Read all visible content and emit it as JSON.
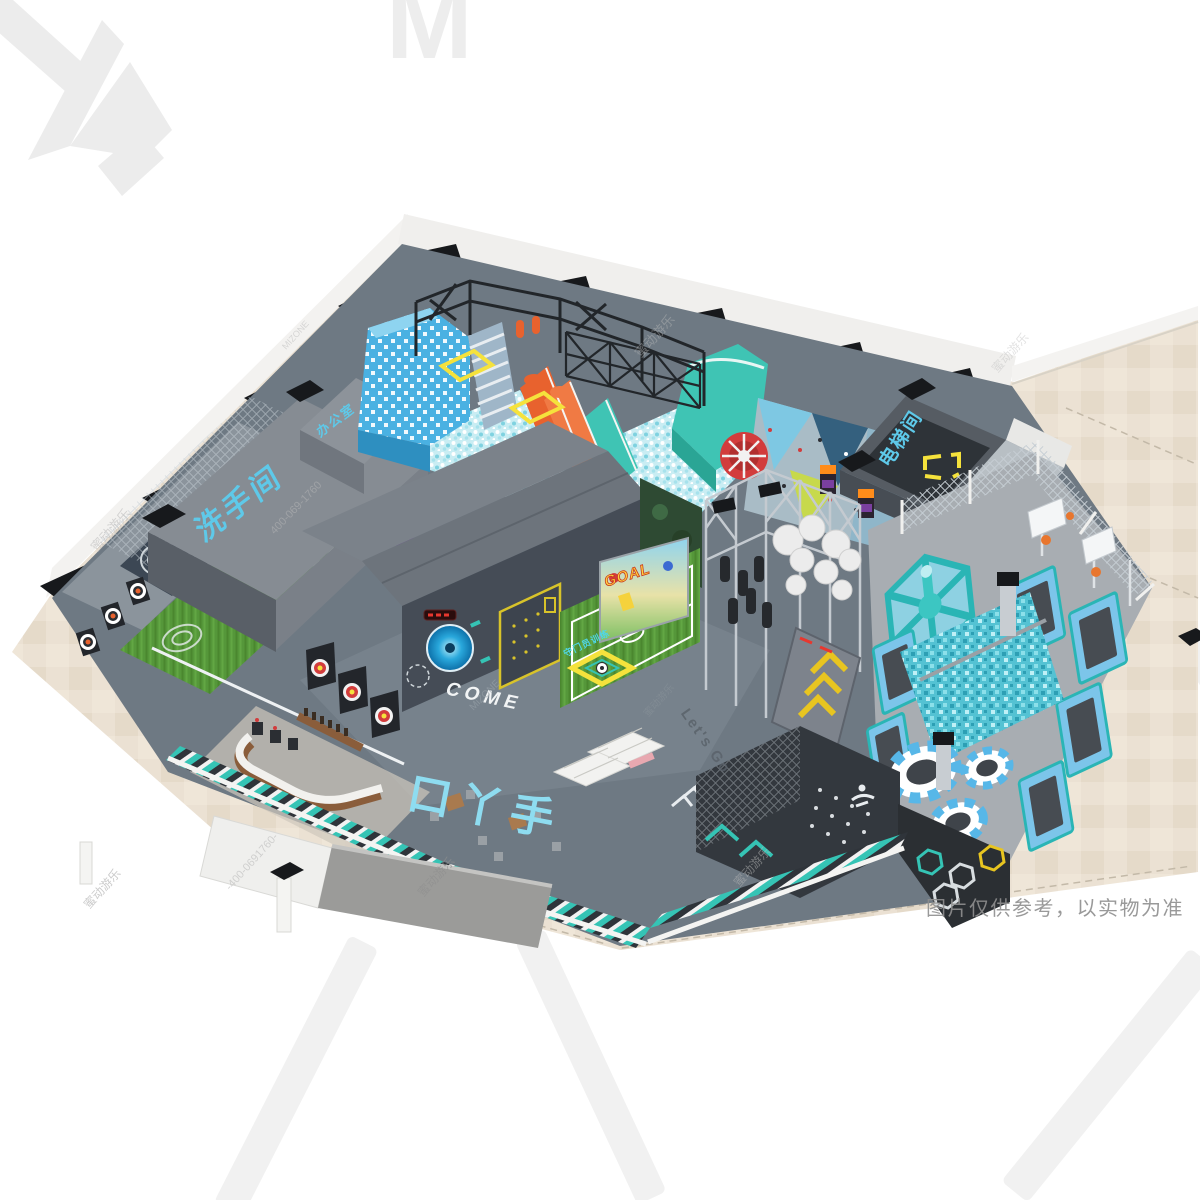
{
  "meta": {
    "disclaimer": "图片仅供参考，以实物为准"
  },
  "branding": {
    "logo_mark_letter": "M",
    "brand_cn": "蜜动游乐",
    "brand_en_caps": "MIZONE",
    "brand_en_mixed": "MiZONE",
    "phone": "400-069-1760",
    "phone_dash": "-400-0691760-"
  },
  "labels": {
    "restroom": "洗手间",
    "office": "办公室",
    "elevator": "电梯间",
    "come": "COME",
    "entrance_floor": "口丫手",
    "goalkeeper_sign": "守门员训练",
    "goal_screen": "GOAL",
    "lets_go": "Let's Go"
  },
  "palette": {
    "cyan": "#5ec9e9",
    "lightcyan": "#8edcf0",
    "teal": "#2ab5b5",
    "tealbright": "#35c4b5",
    "blue": "#4ab1e2",
    "orange": "#e8622e",
    "turf": "#55973a",
    "beige": "#eae0d2",
    "floorgray": "#6e7983",
    "darkwall": "#2f343a",
    "mat": "#474c52",
    "yellow": "#f5e23c",
    "red": "#d23c3c",
    "pink": "#e8a8b0",
    "wood": "#8a5d3b",
    "white": "#f2f1ef"
  }
}
